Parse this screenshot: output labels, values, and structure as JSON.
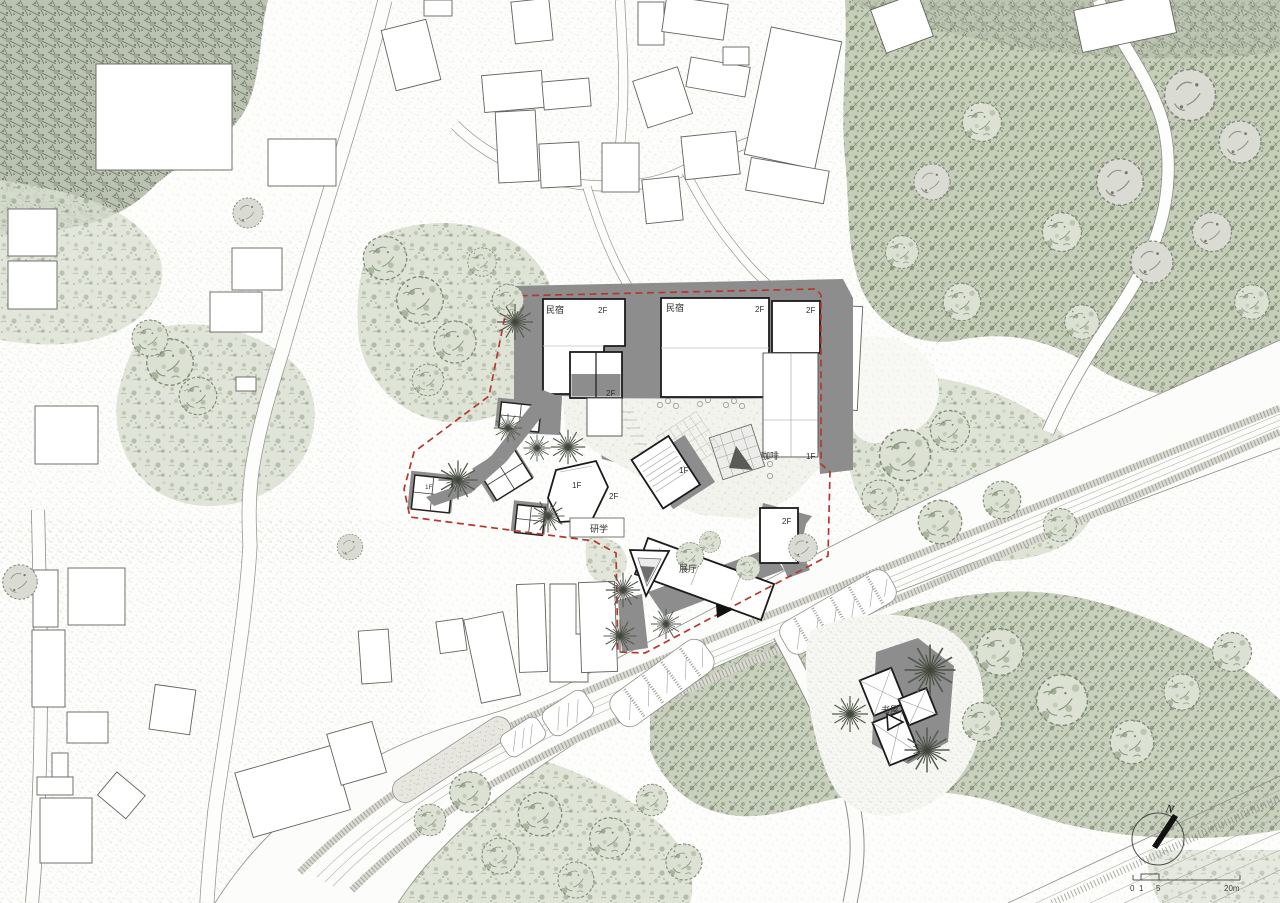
{
  "colors": {
    "paper": "#fdfdfb",
    "boundary_red": "#b5382e",
    "complex_outline": "#1b1b1b",
    "shadow_gray": "#8d8d8d",
    "shadow_dark": "#6f6f6f",
    "veg_green": "#c4cdb9",
    "veg_dark": "#76816d",
    "road_edge": "#8f8f8a",
    "text_dark": "#2d2d2d"
  },
  "labels": [
    {
      "id": "guesthouse-nw",
      "text": "民宿"
    },
    {
      "id": "guesthouse-nw-floor",
      "text": "2F"
    },
    {
      "id": "guesthouse-n",
      "text": "民宿"
    },
    {
      "id": "guesthouse-n-floor",
      "text": "2F"
    },
    {
      "id": "guesthouse-ne-floor",
      "text": "2F"
    },
    {
      "id": "block-mid-floor",
      "text": "2F"
    },
    {
      "id": "stair-hall-floor",
      "text": "1F"
    },
    {
      "id": "coffee",
      "text": "咖啡"
    },
    {
      "id": "coffee-floor",
      "text": "1F"
    },
    {
      "id": "west-wing-floor-1",
      "text": "1F"
    },
    {
      "id": "west-wing-floor-2",
      "text": "2F"
    },
    {
      "id": "study",
      "text": "研学"
    },
    {
      "id": "east-block-floor",
      "text": "2F"
    },
    {
      "id": "exhibition-hall",
      "text": "展厅"
    },
    {
      "id": "pavilion-floor",
      "text": "1F"
    },
    {
      "id": "book-house",
      "text": "书屋"
    }
  ],
  "compass": {
    "north": "N"
  },
  "scale_bar": {
    "ticks": [
      "0",
      "1",
      "5",
      "20m"
    ]
  }
}
